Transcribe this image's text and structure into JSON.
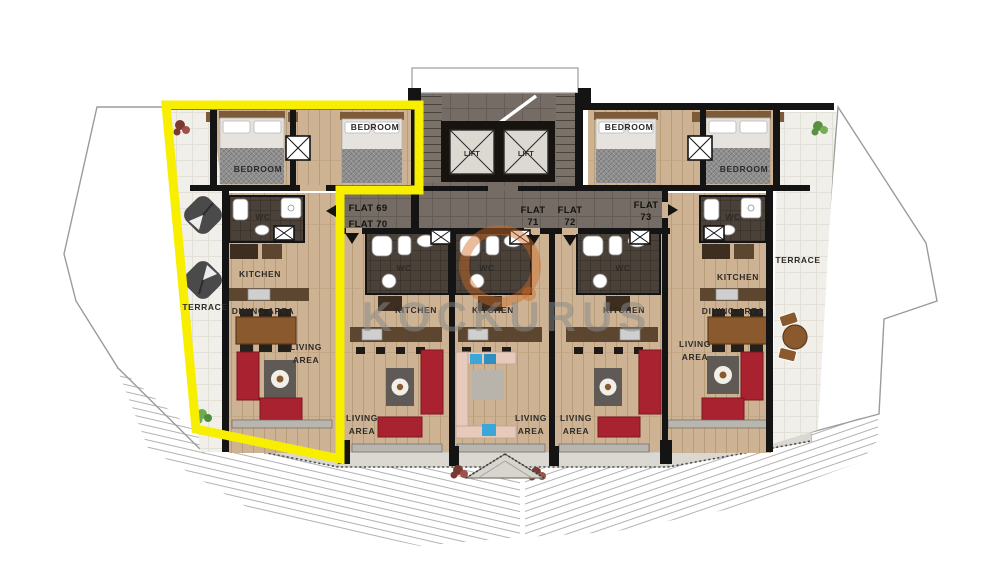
{
  "watermark": {
    "brand": "KOCKURUS",
    "ring_color": "#cf6a26",
    "text_color": "#8a8a8a"
  },
  "highlight": {
    "flat": "FLAT 69",
    "color": "#f8ee00"
  },
  "colors": {
    "wood_floor": "#cdb394",
    "wall": "#141414",
    "corridor_tile": "#756d65",
    "bath_tile": "#4a4139",
    "sofa_red": "#a8232f",
    "terrace_white": "#f1efe9",
    "outline_gray": "#9b9b9b"
  },
  "room_labels": [
    {
      "name": "bedroom-1-label",
      "label": "BEDROOM",
      "x": 258,
      "y": 172
    },
    {
      "name": "bedroom-2-label",
      "label": "BEDROOM",
      "x": 375,
      "y": 130
    },
    {
      "name": "bedroom-3-label",
      "label": "BEDROOM",
      "x": 629,
      "y": 130
    },
    {
      "name": "bedroom-4-label",
      "label": "BEDROOM",
      "x": 744,
      "y": 172
    },
    {
      "name": "wc-69-label",
      "label": "WC",
      "x": 263,
      "y": 220
    },
    {
      "name": "wc-70-label",
      "label": "WC",
      "x": 404,
      "y": 271
    },
    {
      "name": "wc-71-label",
      "label": "WC",
      "x": 487,
      "y": 271
    },
    {
      "name": "wc-72-label",
      "label": "WC",
      "x": 623,
      "y": 271
    },
    {
      "name": "wc-73-label",
      "label": "WC",
      "x": 733,
      "y": 220
    },
    {
      "name": "kitchen-69-label",
      "label": "KITCHEN",
      "x": 260,
      "y": 277
    },
    {
      "name": "kitchen-70-label",
      "label": "KITCHEN",
      "x": 416,
      "y": 313
    },
    {
      "name": "kitchen-71-label",
      "label": "KITCHEN",
      "x": 493,
      "y": 313
    },
    {
      "name": "kitchen-72-label",
      "label": "KITCHEN",
      "x": 624,
      "y": 313
    },
    {
      "name": "kitchen-73-label",
      "label": "KITCHEN",
      "x": 738,
      "y": 280
    },
    {
      "name": "dining-69-label",
      "label": "DINING AREA",
      "x": 263,
      "y": 314
    },
    {
      "name": "dining-73-label",
      "label": "DINING AREA",
      "x": 733,
      "y": 314
    },
    {
      "name": "living-69-label",
      "label": "LIVING",
      "line2": "AREA",
      "x": 306,
      "y": 350
    },
    {
      "name": "living-70-label",
      "label": "LIVING",
      "line2": "AREA",
      "x": 362,
      "y": 421
    },
    {
      "name": "living-71-label",
      "label": "LIVING",
      "line2": "AREA",
      "x": 531,
      "y": 421
    },
    {
      "name": "living-72-label",
      "label": "LIVING",
      "line2": "AREA",
      "x": 576,
      "y": 421
    },
    {
      "name": "living-73-label",
      "label": "LIVING",
      "line2": "AREA",
      "x": 695,
      "y": 347
    },
    {
      "name": "terrace-left-label",
      "label": "TERRACE",
      "x": 205,
      "y": 310
    },
    {
      "name": "terrace-right-label",
      "label": "TERRACE",
      "x": 798,
      "y": 263
    },
    {
      "name": "lift-1-label",
      "label": "LIFT",
      "x": 472,
      "y": 156,
      "small": true
    },
    {
      "name": "lift-2-label",
      "label": "LIFT",
      "x": 526,
      "y": 156,
      "small": true
    }
  ],
  "flat_tags": [
    {
      "name": "flat-69-tag",
      "label": "FLAT 69",
      "x": 368,
      "y": 211,
      "arrow": "left",
      "tip": [
        326,
        211
      ]
    },
    {
      "name": "flat-70-tag",
      "label": "FLAT 70",
      "x": 368,
      "y": 227,
      "arrow": "down",
      "tip": [
        352,
        244
      ]
    },
    {
      "name": "flat-71-tag",
      "label": "FLAT",
      "line2": "71",
      "x": 533,
      "y": 213,
      "arrow": "down",
      "tip": [
        533,
        246
      ]
    },
    {
      "name": "flat-72-tag",
      "label": "FLAT",
      "line2": "72",
      "x": 570,
      "y": 213,
      "arrow": "down",
      "tip": [
        570,
        246
      ]
    },
    {
      "name": "flat-73-tag",
      "label": "FLAT",
      "line2": "73",
      "x": 646,
      "y": 208,
      "arrow": "right",
      "tip": [
        678,
        210
      ]
    }
  ]
}
